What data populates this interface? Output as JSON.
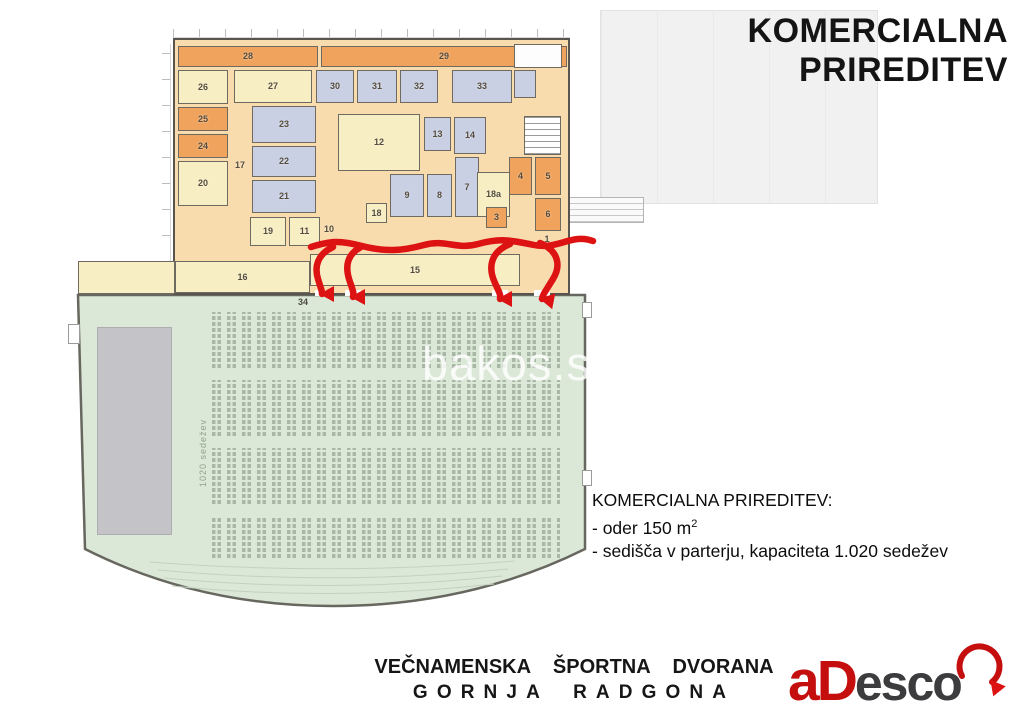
{
  "title": {
    "line1": "KOMERCIALNA",
    "line2": "PRIREDITEV"
  },
  "watermark": "bakos.s",
  "annotation": {
    "heading": "KOMERCIALNA PRIREDITEV:",
    "oder_prefix": "- oder 150 m",
    "oder_sup": "2",
    "seats_line": "- sedišča v parterju, kapaciteta 1.020 sedežev"
  },
  "footer": {
    "line1": "VEČNAMENSKA ŠPORTNA DVORANA",
    "line2": "GORNJA RADGONA",
    "logo_red": "aD",
    "logo_dark": "esco"
  },
  "plan": {
    "hall": {
      "number": "34",
      "capacity_label": "1020 sedežev"
    },
    "rooms": [
      {
        "label": "28",
        "x": 178,
        "y": 46,
        "w": 140,
        "h": 21,
        "t": "orange"
      },
      {
        "label": "29",
        "x": 321,
        "y": 46,
        "w": 246,
        "h": 21,
        "t": "orange"
      },
      {
        "label": "26",
        "x": 178,
        "y": 70,
        "w": 50,
        "h": 34,
        "t": "yellow"
      },
      {
        "label": "27",
        "x": 234,
        "y": 70,
        "w": 78,
        "h": 33,
        "t": "yellow"
      },
      {
        "label": "30",
        "x": 316,
        "y": 70,
        "w": 38,
        "h": 33,
        "t": "blue"
      },
      {
        "label": "31",
        "x": 357,
        "y": 70,
        "w": 40,
        "h": 33,
        "t": "blue"
      },
      {
        "label": "32",
        "x": 400,
        "y": 70,
        "w": 38,
        "h": 33,
        "t": "blue"
      },
      {
        "label": "33",
        "x": 452,
        "y": 70,
        "w": 60,
        "h": 33,
        "t": "blue"
      },
      {
        "label": "",
        "x": 514,
        "y": 44,
        "w": 48,
        "h": 24,
        "t": "white"
      },
      {
        "label": "",
        "x": 514,
        "y": 70,
        "w": 22,
        "h": 28,
        "t": "blue"
      },
      {
        "label": "25",
        "x": 178,
        "y": 107,
        "w": 50,
        "h": 24,
        "t": "orange"
      },
      {
        "label": "24",
        "x": 178,
        "y": 134,
        "w": 50,
        "h": 24,
        "t": "orange"
      },
      {
        "label": "20",
        "x": 178,
        "y": 161,
        "w": 50,
        "h": 45,
        "t": "yellow"
      },
      {
        "label": "17",
        "x": 230,
        "y": 106,
        "w": 20,
        "h": 118,
        "t": "none"
      },
      {
        "label": "23",
        "x": 252,
        "y": 106,
        "w": 64,
        "h": 37,
        "t": "blue"
      },
      {
        "label": "22",
        "x": 252,
        "y": 146,
        "w": 64,
        "h": 31,
        "t": "blue"
      },
      {
        "label": "21",
        "x": 252,
        "y": 180,
        "w": 64,
        "h": 33,
        "t": "blue"
      },
      {
        "label": "19",
        "x": 250,
        "y": 217,
        "w": 36,
        "h": 29,
        "t": "yellow"
      },
      {
        "label": "11",
        "x": 289,
        "y": 217,
        "w": 31,
        "h": 29,
        "t": "yellow"
      },
      {
        "label": "12",
        "x": 338,
        "y": 114,
        "w": 82,
        "h": 57,
        "t": "yellow"
      },
      {
        "label": "13",
        "x": 424,
        "y": 117,
        "w": 27,
        "h": 34,
        "t": "blue"
      },
      {
        "label": "14",
        "x": 454,
        "y": 117,
        "w": 32,
        "h": 37,
        "t": "blue"
      },
      {
        "label": "9",
        "x": 390,
        "y": 174,
        "w": 34,
        "h": 43,
        "t": "blue"
      },
      {
        "label": "8",
        "x": 427,
        "y": 174,
        "w": 25,
        "h": 43,
        "t": "blue"
      },
      {
        "label": "7",
        "x": 455,
        "y": 157,
        "w": 24,
        "h": 60,
        "t": "blue"
      },
      {
        "label": "18a",
        "x": 477,
        "y": 172,
        "w": 33,
        "h": 45,
        "t": "yellow"
      },
      {
        "label": "18",
        "x": 366,
        "y": 203,
        "w": 21,
        "h": 20,
        "t": "yellow"
      },
      {
        "label": "3",
        "x": 486,
        "y": 207,
        "w": 21,
        "h": 21,
        "t": "orange"
      },
      {
        "label": "10",
        "x": 318,
        "y": 222,
        "w": 22,
        "h": 14,
        "t": "none"
      },
      {
        "label": "2",
        "x": 492,
        "y": 238,
        "w": 20,
        "h": 14,
        "t": "none"
      },
      {
        "label": "1",
        "x": 538,
        "y": 232,
        "w": 18,
        "h": 14,
        "t": "none"
      },
      {
        "label": "4",
        "x": 509,
        "y": 157,
        "w": 23,
        "h": 38,
        "t": "orange"
      },
      {
        "label": "5",
        "x": 535,
        "y": 157,
        "w": 26,
        "h": 38,
        "t": "orange"
      },
      {
        "label": "6",
        "x": 535,
        "y": 198,
        "w": 26,
        "h": 33,
        "t": "orange"
      },
      {
        "label": "",
        "x": 524,
        "y": 116,
        "w": 37,
        "h": 39,
        "t": "stairs"
      },
      {
        "label": "15",
        "x": 310,
        "y": 254,
        "w": 210,
        "h": 32,
        "t": "yellow"
      },
      {
        "label": "16",
        "x": 175,
        "y": 261,
        "w": 135,
        "h": 32,
        "t": "yellow"
      },
      {
        "label": "",
        "x": 78,
        "y": 261,
        "w": 97,
        "h": 33,
        "t": "yellow"
      }
    ]
  },
  "colors": {
    "arrow_red": "#dd1212",
    "hall_green": "#dce8d7",
    "seat_green": "#a9b8a6",
    "room_orange": "#f0a35c",
    "room_yellow": "#f7eec3",
    "room_blue": "#c9d0e4",
    "wing_peach": "#f8dcae",
    "stage_gray": "#c4c4c8",
    "logo_red": "#c50f0f",
    "logo_dark": "#3c3c3e"
  }
}
